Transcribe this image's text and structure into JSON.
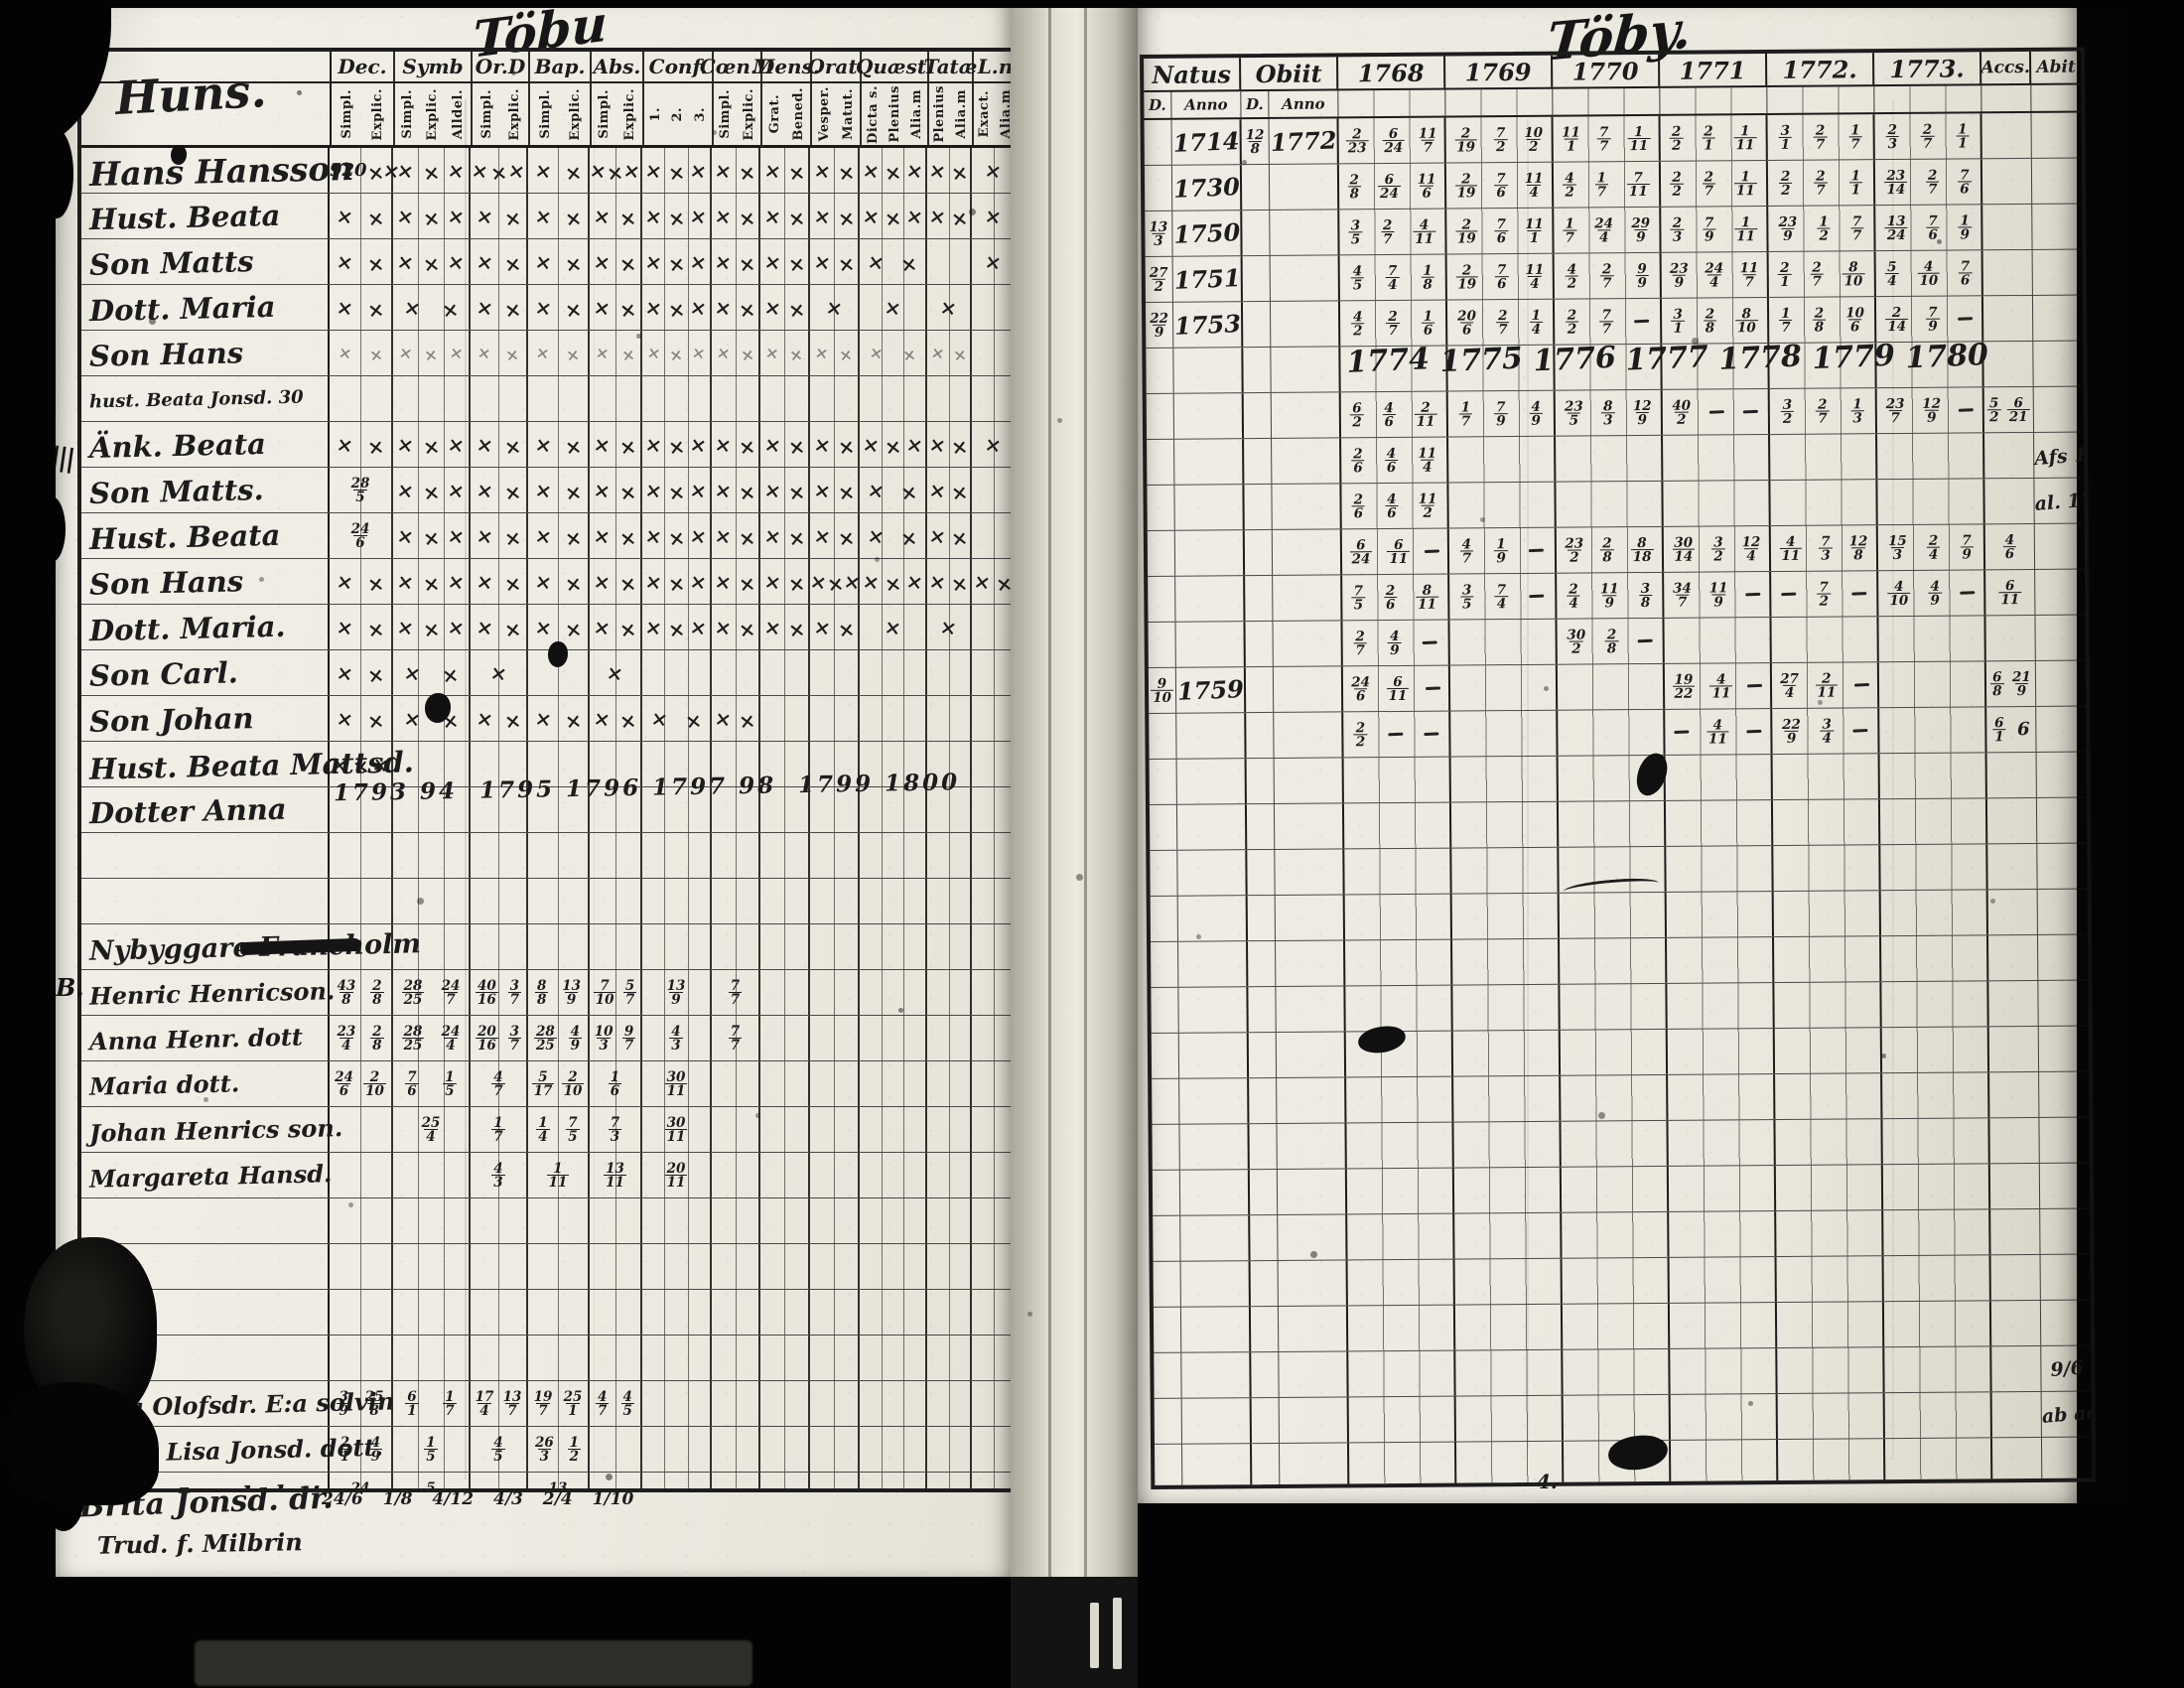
{
  "titles": {
    "left": "Töbu",
    "right": "Töby."
  },
  "left_page": {
    "farm_heading": "Huns.",
    "columns": [
      {
        "label": "Dec.",
        "subs": [
          "Simpl.",
          "Explic."
        ]
      },
      {
        "label": "Symb",
        "subs": [
          "Simpl.",
          "Explic.",
          "Alldel."
        ]
      },
      {
        "label": "Or.D",
        "subs": [
          "Simpl.",
          "Explic."
        ]
      },
      {
        "label": "Bap.",
        "subs": [
          "Simpl.",
          "Explic."
        ]
      },
      {
        "label": "Abs.",
        "subs": [
          "Simpl.",
          "Explic."
        ]
      },
      {
        "label": "Conf.",
        "subs": [
          "1.",
          "2.",
          "3."
        ]
      },
      {
        "label": "Cœn.D",
        "subs": [
          "Simpl.",
          "Explic."
        ]
      },
      {
        "label": "Mens.",
        "subs": [
          "Grat.",
          "Bened."
        ]
      },
      {
        "label": "Orat.",
        "subs": [
          "Vesper.",
          "Matut."
        ]
      },
      {
        "label": "Quæst.",
        "subs": [
          "Dicta s.",
          "Plenius",
          "Alia.m"
        ]
      },
      {
        "label": "Tatæ",
        "subs": [
          "Plenius",
          "Alia.m"
        ]
      },
      {
        "label": "L.n",
        "subs": [
          "Exact.",
          "Alia.m"
        ]
      }
    ],
    "rows": [
      {
        "name": "Hans Hansson",
        "class": "big",
        "cells": [
          "920 ××",
          "×××",
          "×××",
          "××",
          "×××",
          "×××",
          "××",
          "××",
          "××",
          "×××",
          "××",
          "×"
        ]
      },
      {
        "name": "Hust. Beata",
        "cells": [
          "××",
          "×××",
          "××",
          "××",
          "××",
          "×××",
          "××",
          "××",
          "××",
          "×××",
          "××",
          "×"
        ]
      },
      {
        "name": "Son Matts",
        "cells": [
          "××",
          "×××",
          "××",
          "××",
          "××",
          "×××",
          "××",
          "××",
          "××",
          "××",
          "",
          "×"
        ]
      },
      {
        "name": "Dott. Maria",
        "cells": [
          "××",
          "××",
          "××",
          "××",
          "××",
          "×××",
          "××",
          "××",
          "×",
          "×",
          "×",
          ""
        ]
      },
      {
        "name": "Son Hans",
        "class": "light",
        "cells": [
          "××",
          "×××",
          "××",
          "××",
          "××",
          "×××",
          "××",
          "××",
          "××",
          "××",
          "××",
          ""
        ]
      },
      {
        "name": "hust. Beata Jonsd. 30",
        "class": "tiny"
      },
      {
        "name": "Änk. Beata",
        "cells": [
          "××",
          "×××",
          "××",
          "××",
          "××",
          "×××",
          "××",
          "××",
          "××",
          "×××",
          "××",
          "×"
        ]
      },
      {
        "name": "Son Matts.",
        "cells": [
          "28/5",
          "×××",
          "××",
          "××",
          "××",
          "×××",
          "××",
          "××",
          "××",
          "××",
          "××",
          ""
        ]
      },
      {
        "name": "Hust. Beata",
        "cells": [
          "24/6",
          "×××",
          "××",
          "××",
          "××",
          "×××",
          "××",
          "××",
          "××",
          "××",
          "××",
          ""
        ]
      },
      {
        "name": "Son Hans",
        "cells": [
          "××",
          "×××",
          "××",
          "××",
          "××",
          "×××",
          "××",
          "××",
          "×××",
          "×××",
          "××",
          "××"
        ]
      },
      {
        "name": "Dott. Maria.",
        "cells": [
          "××",
          "×××",
          "××",
          "××",
          "××",
          "×××",
          "××",
          "××",
          "××",
          "×",
          "×",
          ""
        ]
      },
      {
        "name": "Son Carl.",
        "cells": [
          "××",
          "××",
          "×",
          "",
          "×",
          "",
          "",
          "",
          "",
          "",
          "",
          ""
        ]
      },
      {
        "name": "Son Johan",
        "cells": [
          "××",
          "××",
          "××",
          "××",
          "××",
          "××",
          "××",
          "",
          "",
          "",
          "",
          ""
        ]
      },
      {
        "name": "Hust. Beata Mattsd.",
        "cells": [
          "×××",
          "",
          "",
          "",
          "",
          "",
          "",
          "",
          "",
          "",
          "",
          ""
        ]
      },
      {
        "name": "Dotter Anna",
        "note": "1793 94  1795 1796 1797 98  1799 1800"
      },
      {
        "name": ""
      },
      {
        "name": ""
      },
      {
        "name": "Nybyggare  Francholm",
        "class": "section"
      },
      {
        "name": "Henric Henricson.",
        "class": "mid",
        "cells": [
          "43/8 2/8",
          "28/25 24/7",
          "40/16 3/7",
          "8/8 13/9",
          "7/10 5/7",
          "13/9",
          "7/7",
          "",
          "",
          "",
          "",
          ""
        ]
      },
      {
        "name": "Anna Henr. dott",
        "class": "mid",
        "cells": [
          "23/4 2/8",
          "28/25 24/4",
          "20/16 3/7",
          "28/25 4/9",
          "10/3 9/7",
          "4/3",
          "7/7",
          "",
          "",
          "",
          "",
          ""
        ]
      },
      {
        "name": "Maria dott.",
        "class": "mid",
        "cells": [
          "24/6 2/10",
          "7/6 1/5",
          "4/7",
          "5/17 2/10",
          "1/6",
          "30/11",
          "",
          "",
          "",
          "",
          "",
          ""
        ]
      },
      {
        "name": "Johan Henrics son.",
        "class": "mid",
        "cells": [
          "",
          "25/4",
          "1/7",
          "1/4 7/5",
          "7/3",
          "30/11",
          "",
          "",
          "",
          "",
          "",
          ""
        ]
      },
      {
        "name": "Margareta Hansd.",
        "class": "mid",
        "cells": [
          "",
          "",
          "4/3",
          "1/11",
          "13/11",
          "20/11",
          "",
          "",
          "",
          "",
          "",
          ""
        ]
      },
      {
        "name": ""
      },
      {
        "name": ""
      },
      {
        "name": ""
      },
      {
        "name": ""
      },
      {
        "name": "Lisa Olofsdr. E:a solvin",
        "class": "mid",
        "cells": [
          "3/9 25/8",
          "6/1 1/7",
          "17/4 13/7",
          "19/7 25/1",
          "4/7 4/5",
          "",
          "",
          "",
          "",
          "",
          "",
          ""
        ]
      },
      {
        "name": "Anna Lisa Jonsd. dott.",
        "class": "mid",
        "cells": [
          "2/1 4/9",
          "1/5",
          "4/5",
          "26/3 1/2",
          "",
          "",
          "",
          "",
          "",
          "",
          "",
          ""
        ]
      },
      {
        "name": "Maria Jonsd. dott.",
        "class": "mid",
        "cells": [
          "24/6",
          "5/9",
          "",
          "13/4",
          "",
          "",
          "",
          "",
          "",
          "",
          "",
          ""
        ]
      }
    ],
    "margin_marks": {
      "tally": "||||",
      "cross": "✗",
      "letter": "B."
    },
    "below_lines": {
      "line1": "Brita Jonsd. dr.",
      "line2": "Trud. f. Milbrin",
      "numbers": "24/6   1/8   4/12   4/3   2/4   1/10"
    }
  },
  "right_page": {
    "header": {
      "natus": "Natus",
      "obiit": "Obiit",
      "d": "D.",
      "anno": "Anno",
      "years": [
        "1768",
        "1769",
        "1770",
        "1771",
        "1772.",
        "1773."
      ],
      "accs": "Accs.",
      "abit": "Abit"
    },
    "inline_years": [
      "1774",
      "1775",
      "1776",
      "1777",
      "1778",
      "1779",
      "1780"
    ],
    "rows": [
      {
        "natus": "1714",
        "obiit_d": "12/8",
        "obiit": "1772",
        "years": [
          "2/23 6/24 11/7",
          "2/19 7/2 10/2",
          "11/1 7/7 1/11",
          "2/2 2/1 1/11",
          "3/1 2/7 1/7",
          "2/3 2/7 1/1"
        ]
      },
      {
        "natus": "1730",
        "years": [
          "2/8 6/24 11/6",
          "2/19 7/6 11/4",
          "4/2 1/7 7/11",
          "2/2 2/7 1/11",
          "2/2 2/7 1/1",
          "23/14 2/7 7/6"
        ]
      },
      {
        "natus_d": "13/3",
        "natus": "1750",
        "years": [
          "3/5 2/7 4/11",
          "2/19 7/6 11/1",
          "1/7 24/4 29/9",
          "2/3 7/9 1/11",
          "23/9 1/2 7/7",
          "13/24 7/6 1/9"
        ]
      },
      {
        "natus_d": "27/2",
        "natus": "1751",
        "years": [
          "4/5 7/4 1/8",
          "2/19 7/6 11/4",
          "4/2 2/7 9/9",
          "23/9 24/4 11/7",
          "2/1 2/7 8/10",
          "5/4 4/10 7/6"
        ]
      },
      {
        "natus_d": "22/9",
        "natus": "1753",
        "years": [
          "4/2 2/7 1/6",
          "20/6 2/7 1/4",
          "2/2 7/7 —",
          "3/1 2/8 8/10",
          "1/7 2/8 10/6",
          "2/14 7/9 —"
        ]
      },
      {},
      {
        "years": [
          "6/2 4/6 2/11",
          "1/7 7/9 4/9",
          "23/5 8/3 12/9",
          "40/2 — —",
          "3/2 2/7 1/3",
          "23/7 12/9 —"
        ],
        "accs": "5/2 6/21"
      },
      {
        "years": [
          "2/6 4/6 11/4",
          "",
          "",
          "",
          "",
          ""
        ],
        "abit": "Afs 1777"
      },
      {
        "years": [
          "2/6 4/6 11/2",
          "",
          "",
          "",
          "",
          ""
        ],
        "abit": "al. 1777"
      },
      {
        "years": [
          "6/24 6/11 —",
          "4/7 1/9 —",
          "23/2 2/8 8/18",
          "30/14 3/2 12/4",
          "4/11 7/3 12/8",
          "15/3 2/4 7/9"
        ],
        "accs": "4/6"
      },
      {
        "years": [
          "7/5 2/6 8/11",
          "3/5 7/4 —",
          "2/4 11/9 3/8",
          "34/7 11/9 —",
          "— 7/2 —",
          "4/10 4/9 —"
        ],
        "accs": "6/11"
      },
      {
        "years": [
          "2/7 4/9 —",
          "",
          "30/2 2/8 —",
          "",
          "",
          ""
        ]
      },
      {
        "natus_d": "9/10",
        "natus": "1759",
        "years": [
          "24/6 6/11 —",
          "",
          "",
          "19/22 4/11 —",
          "27/4 2/11 —",
          ""
        ],
        "accs": "6/8 21/9"
      },
      {
        "years": [
          "2/2 — —",
          "",
          "",
          "— 4/11 —",
          "22/9 3/4 —",
          ""
        ],
        "accs": "6/1 6"
      },
      {},
      {},
      {},
      {},
      {},
      {},
      {},
      {},
      {},
      {},
      {},
      {},
      {},
      {
        "abit": "9/6"
      },
      {
        "abit": "ab ao"
      },
      {}
    ],
    "below_mark": "4."
  }
}
